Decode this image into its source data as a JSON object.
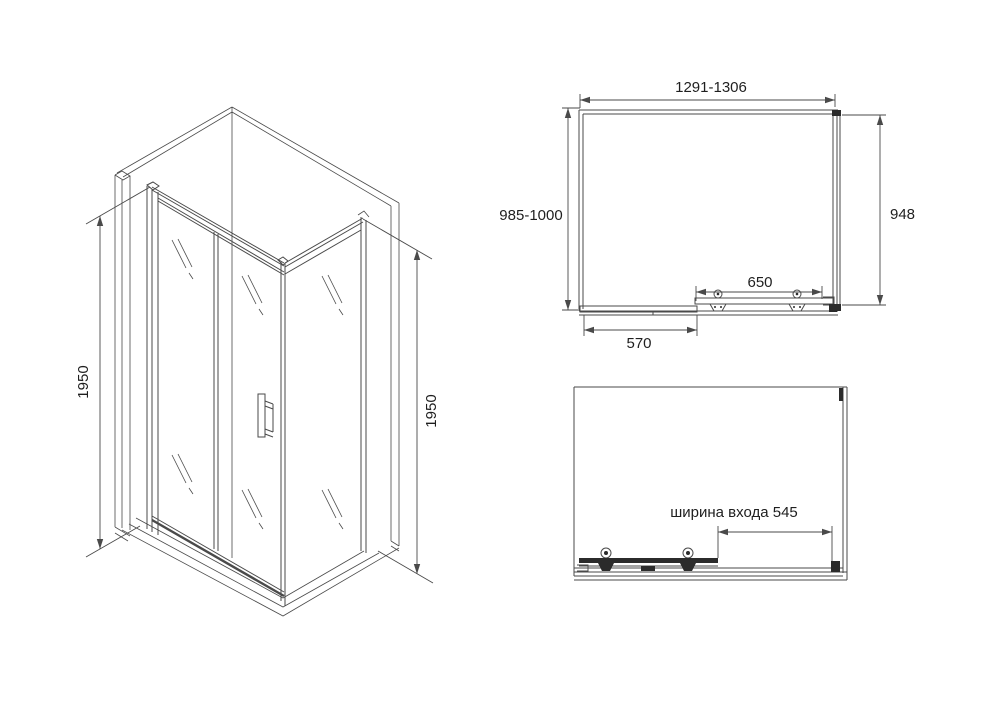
{
  "colors": {
    "background": "#ffffff",
    "line": "#4a4a4a",
    "line_dark": "#2b2b2b",
    "text": "#1f1f1f"
  },
  "isometric_view": {
    "height_left": "1950",
    "height_right": "1950"
  },
  "top_view": {
    "width_range": "1291-1306",
    "depth_range": "985-1000",
    "side_panel_depth": "948",
    "door_rail_width": "650",
    "fixed_panel_width": "570"
  },
  "front_view": {
    "entrance_width": "ширина входа 545"
  }
}
